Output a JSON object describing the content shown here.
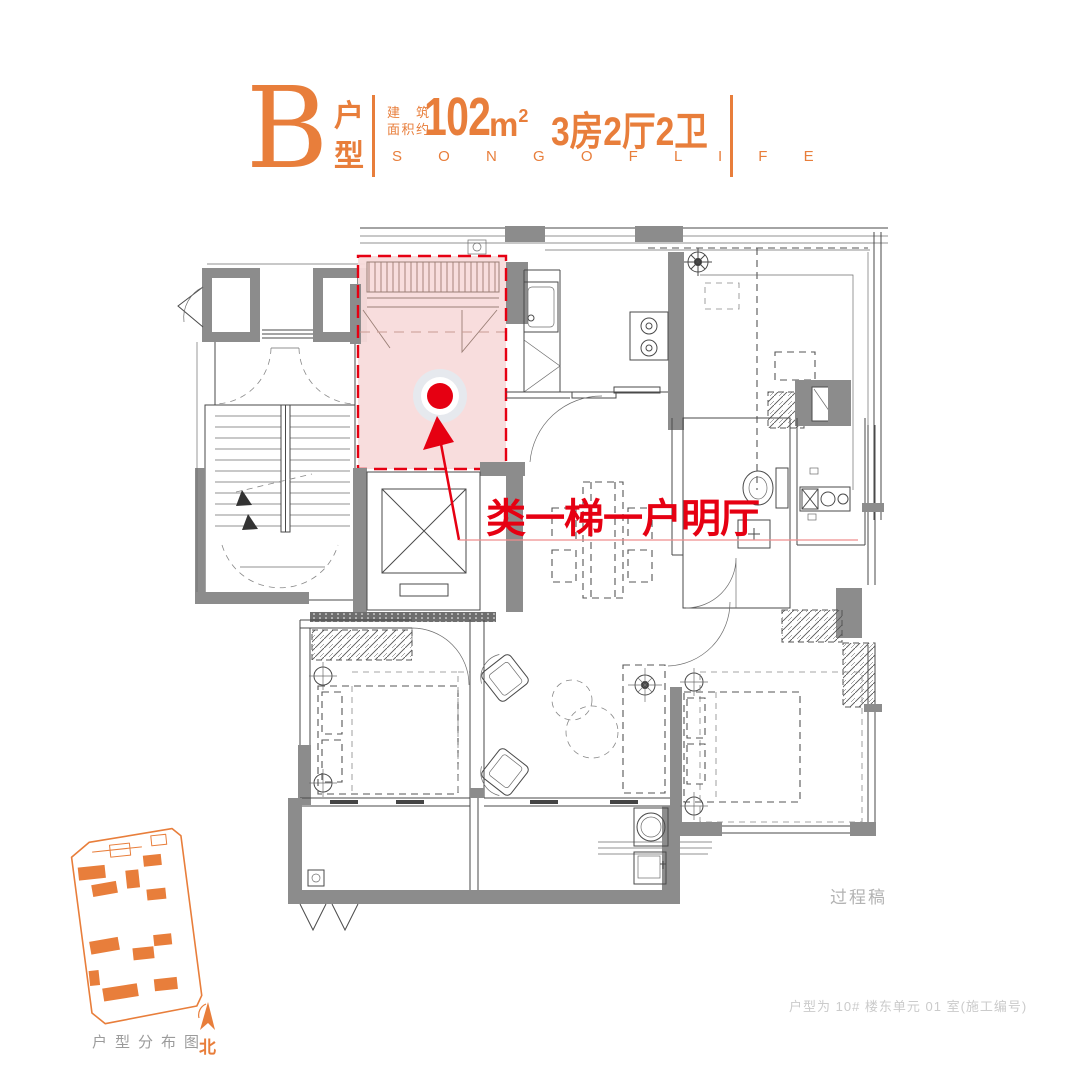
{
  "colors": {
    "accent": "#e87e3b",
    "annotation_red": "#e60012",
    "highlight_pink": "#f8dbdb",
    "wall_gray": "#8c8c8c"
  },
  "header": {
    "type_letter": "B",
    "type_label_char1": "户",
    "type_label_char2": "型",
    "area_prefix_line1": "建 筑",
    "area_prefix_line2": "面积约",
    "area_value": "102",
    "area_unit": "m",
    "area_exponent": "2",
    "rooms_text": "3房2厅2卫",
    "slogan": "S O N G   O F   L I F E"
  },
  "plan": {
    "annotation_text": "类一梯一户明厅",
    "draft_watermark": "过程稿",
    "unit_note": "户型为 10# 楼东单元 01 室(施工编号)"
  },
  "minimap": {
    "caption": "户型分布图",
    "north_label": "北"
  }
}
